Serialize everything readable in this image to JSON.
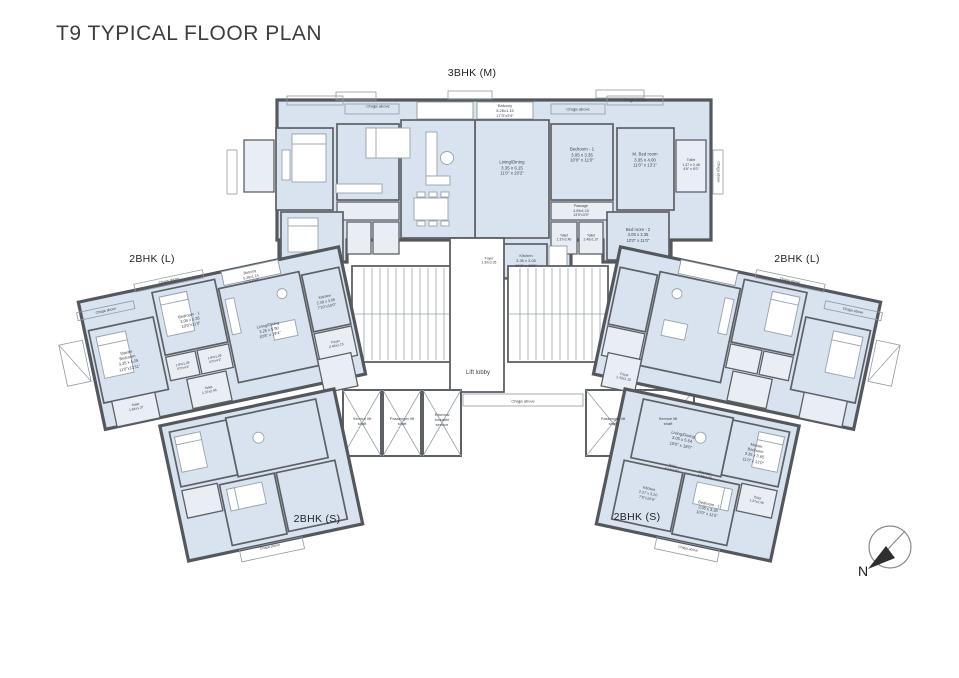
{
  "page": {
    "title": "T9 TYPICAL FLOOR PLAN"
  },
  "units": {
    "top": "3BHK (M)",
    "left": "2BHK (L)",
    "right": "2BHK (L)",
    "bottom_left": "2BHK (S)",
    "bottom_right": "2BHK (S)"
  },
  "compass": {
    "north_label": "N"
  },
  "colors": {
    "room_fill": "#d9e3f0",
    "room_fill_light": "#e9eef5",
    "wall": "#5d6166",
    "light_line": "#8f99a4",
    "text": "#3f444a"
  },
  "plan": {
    "labels": [
      {
        "n": "balcony-label",
        "t": "Balcony\n5.26x1.15\n17'3\"x3'9\"",
        "x": 505,
        "y": 111,
        "s": 4
      },
      {
        "n": "chajja-label",
        "t": "Chajja above",
        "x": 578,
        "y": 109,
        "s": 4
      },
      {
        "n": "chajja-label",
        "t": "Chajja above",
        "x": 635,
        "y": 100,
        "s": 4
      },
      {
        "n": "chajja-label",
        "t": "Chajja above",
        "x": 378,
        "y": 106,
        "s": 4
      },
      {
        "n": "room-label",
        "t": "Living/Dining\n3.35 x 6.15\n11'0\" x 20'2\"",
        "x": 512,
        "y": 168,
        "s": 4.4
      },
      {
        "n": "room-label",
        "t": "Bedroom - 1\n3.05 x 3.35\n10'0\" x 11'0\"",
        "x": 582,
        "y": 155,
        "s": 4.4
      },
      {
        "n": "room-label",
        "t": "M. Bed room\n3.35 x 4.00\n11'0\" x 13'1\"",
        "x": 645,
        "y": 160,
        "s": 4.4
      },
      {
        "n": "room-label",
        "t": "Toilet\n1.37 x 2.46\n4'6\" x 8'0\"",
        "x": 691,
        "y": 165,
        "s": 3.6
      },
      {
        "n": "room-label",
        "t": "Passage\n4.09x1.15\n13'5\"x3'9\"",
        "x": 581,
        "y": 211,
        "s": 3.6
      },
      {
        "n": "room-label",
        "t": "Toilet\n1.37x2.46",
        "x": 564,
        "y": 238,
        "s": 3.4
      },
      {
        "n": "room-label",
        "t": "Toilet\n2.46x1.37",
        "x": 591,
        "y": 238,
        "s": 3.4
      },
      {
        "n": "room-label",
        "t": "Bed room - 2\n3.05 x 3.35\n10'0\" x 11'0\"",
        "x": 638,
        "y": 235,
        "s": 4.2
      },
      {
        "n": "chajja-label",
        "t": "Chajja above",
        "x": 718,
        "y": 172,
        "r": 90,
        "s": 3.6
      },
      {
        "n": "room-label",
        "t": "Foyer\n1.50x2.35",
        "x": 489,
        "y": 261,
        "s": 3.4
      },
      {
        "n": "room-label",
        "t": "Kitchen\n3.35 x 3.05\n11'0\" x 10'0\"",
        "x": 526,
        "y": 261,
        "s": 4
      },
      {
        "n": "lobby-label",
        "t": "Lift lobby",
        "x": 478,
        "y": 374,
        "s": 6
      },
      {
        "n": "chajja-label",
        "t": "Chajja above",
        "x": 523,
        "y": 401,
        "s": 4
      },
      {
        "n": "shaft-label",
        "t": "Service lift\nshaft",
        "x": 362,
        "y": 421,
        "s": 4
      },
      {
        "n": "shaft-label",
        "t": "Passenger lift\nshaft",
        "x": 402,
        "y": 421,
        "s": 4
      },
      {
        "n": "shaft-label",
        "t": "External\nlockable\nservice",
        "x": 442,
        "y": 420,
        "s": 4
      },
      {
        "n": "shaft-label",
        "t": "Passenger lift\nshaft",
        "x": 613,
        "y": 421,
        "s": 4
      },
      {
        "n": "shaft-label",
        "t": "Service lift\nshaft",
        "x": 668,
        "y": 421,
        "s": 4
      },
      {
        "n": "chajja-label",
        "t": "Chajja above",
        "x": 106,
        "y": 311,
        "r": -12,
        "s": 3.6
      },
      {
        "n": "chajja-label",
        "t": "Chajja above",
        "x": 169,
        "y": 281,
        "r": -12,
        "s": 3.6
      },
      {
        "n": "balcony-label",
        "t": "Balcony\n5.26x1.15\n17'3\"x3'9\"",
        "x": 251,
        "y": 277,
        "r": -12,
        "s": 3.6
      },
      {
        "n": "room-label",
        "t": "Bedroom - 1\n3.05 x 3.35\n10'0\"x11'0\"",
        "x": 190,
        "y": 320,
        "r": -12,
        "s": 4
      },
      {
        "n": "room-label",
        "t": "Master\nBedroom\n3.35 x 4.25\n11'0\"x13'11\"",
        "x": 128,
        "y": 360,
        "r": -12,
        "s": 4
      },
      {
        "n": "room-label",
        "t": "Living/Dining\n3.25 x 5.90\n10'8\" x 19'4\"",
        "x": 269,
        "y": 330,
        "r": -12,
        "s": 4
      },
      {
        "n": "room-label",
        "t": "Kitchen\n2.39 x 3.05\n7'10\"x10'0\"",
        "x": 326,
        "y": 302,
        "r": -12,
        "s": 3.8
      },
      {
        "n": "room-label",
        "t": "1.84x1.28\n6'0\"x4'2\"",
        "x": 183,
        "y": 366,
        "r": -12,
        "s": 3.2
      },
      {
        "n": "room-label",
        "t": "1.84x1.28\n6'0\"x4'2\"",
        "x": 215,
        "y": 359,
        "r": -12,
        "s": 3.2
      },
      {
        "n": "room-label",
        "t": "Toilet\n1.84x1.37",
        "x": 136,
        "y": 407,
        "r": -12,
        "s": 3.4
      },
      {
        "n": "room-label",
        "t": "Toilet\n1.37x2.46",
        "x": 209,
        "y": 390,
        "r": -12,
        "s": 3.4
      },
      {
        "n": "room-label",
        "t": "Foyer\n2.46x1.15",
        "x": 336,
        "y": 344,
        "r": -12,
        "s": 3.4
      },
      {
        "n": "chajja-label",
        "t": "Chajja above",
        "x": 270,
        "y": 547,
        "r": -12,
        "s": 3.5
      },
      {
        "n": "chajja-label",
        "t": "Chajja above",
        "x": 853,
        "y": 311,
        "r": 12,
        "s": 3.6
      },
      {
        "n": "chajja-label",
        "t": "Chajja above",
        "x": 790,
        "y": 281,
        "r": 12,
        "s": 3.6
      },
      {
        "n": "room-label",
        "t": "Foyer\n2.43x1.15",
        "x": 624,
        "y": 377,
        "r": 12,
        "s": 3.4
      },
      {
        "n": "room-label",
        "t": "Living/Dining\n3.05 x 5.64\n10'0\" x 18'6\"",
        "x": 682,
        "y": 440,
        "r": 12,
        "s": 4.2
      },
      {
        "n": "room-label",
        "t": "Master\nBedroom\n3.35 x 3.65\n11'0\" x 12'0\"",
        "x": 755,
        "y": 453,
        "r": 12,
        "s": 4
      },
      {
        "n": "room-label",
        "t": "Bedroom - 1\n3.05 x 3.35\n10'0\" x 11'0\"",
        "x": 708,
        "y": 509,
        "r": 12,
        "s": 4
      },
      {
        "n": "room-label",
        "t": "Toilet\n1.37x2.46",
        "x": 757,
        "y": 500,
        "r": 12,
        "s": 3.3
      },
      {
        "n": "room-label",
        "t": "Toilet\n2.27x1.37",
        "x": 672,
        "y": 468,
        "r": 12,
        "s": 3.3
      },
      {
        "n": "room-label",
        "t": "Passage\n3.48x1.15",
        "x": 705,
        "y": 475,
        "r": 12,
        "s": 3.3
      },
      {
        "n": "room-label",
        "t": "Kitchen\n2.27 x 3.20\n7'5\"x10'6\"",
        "x": 648,
        "y": 494,
        "r": 12,
        "s": 3.8
      },
      {
        "n": "chajja-label",
        "t": "Chajja above",
        "x": 688,
        "y": 549,
        "r": 12,
        "s": 3.5
      }
    ]
  }
}
